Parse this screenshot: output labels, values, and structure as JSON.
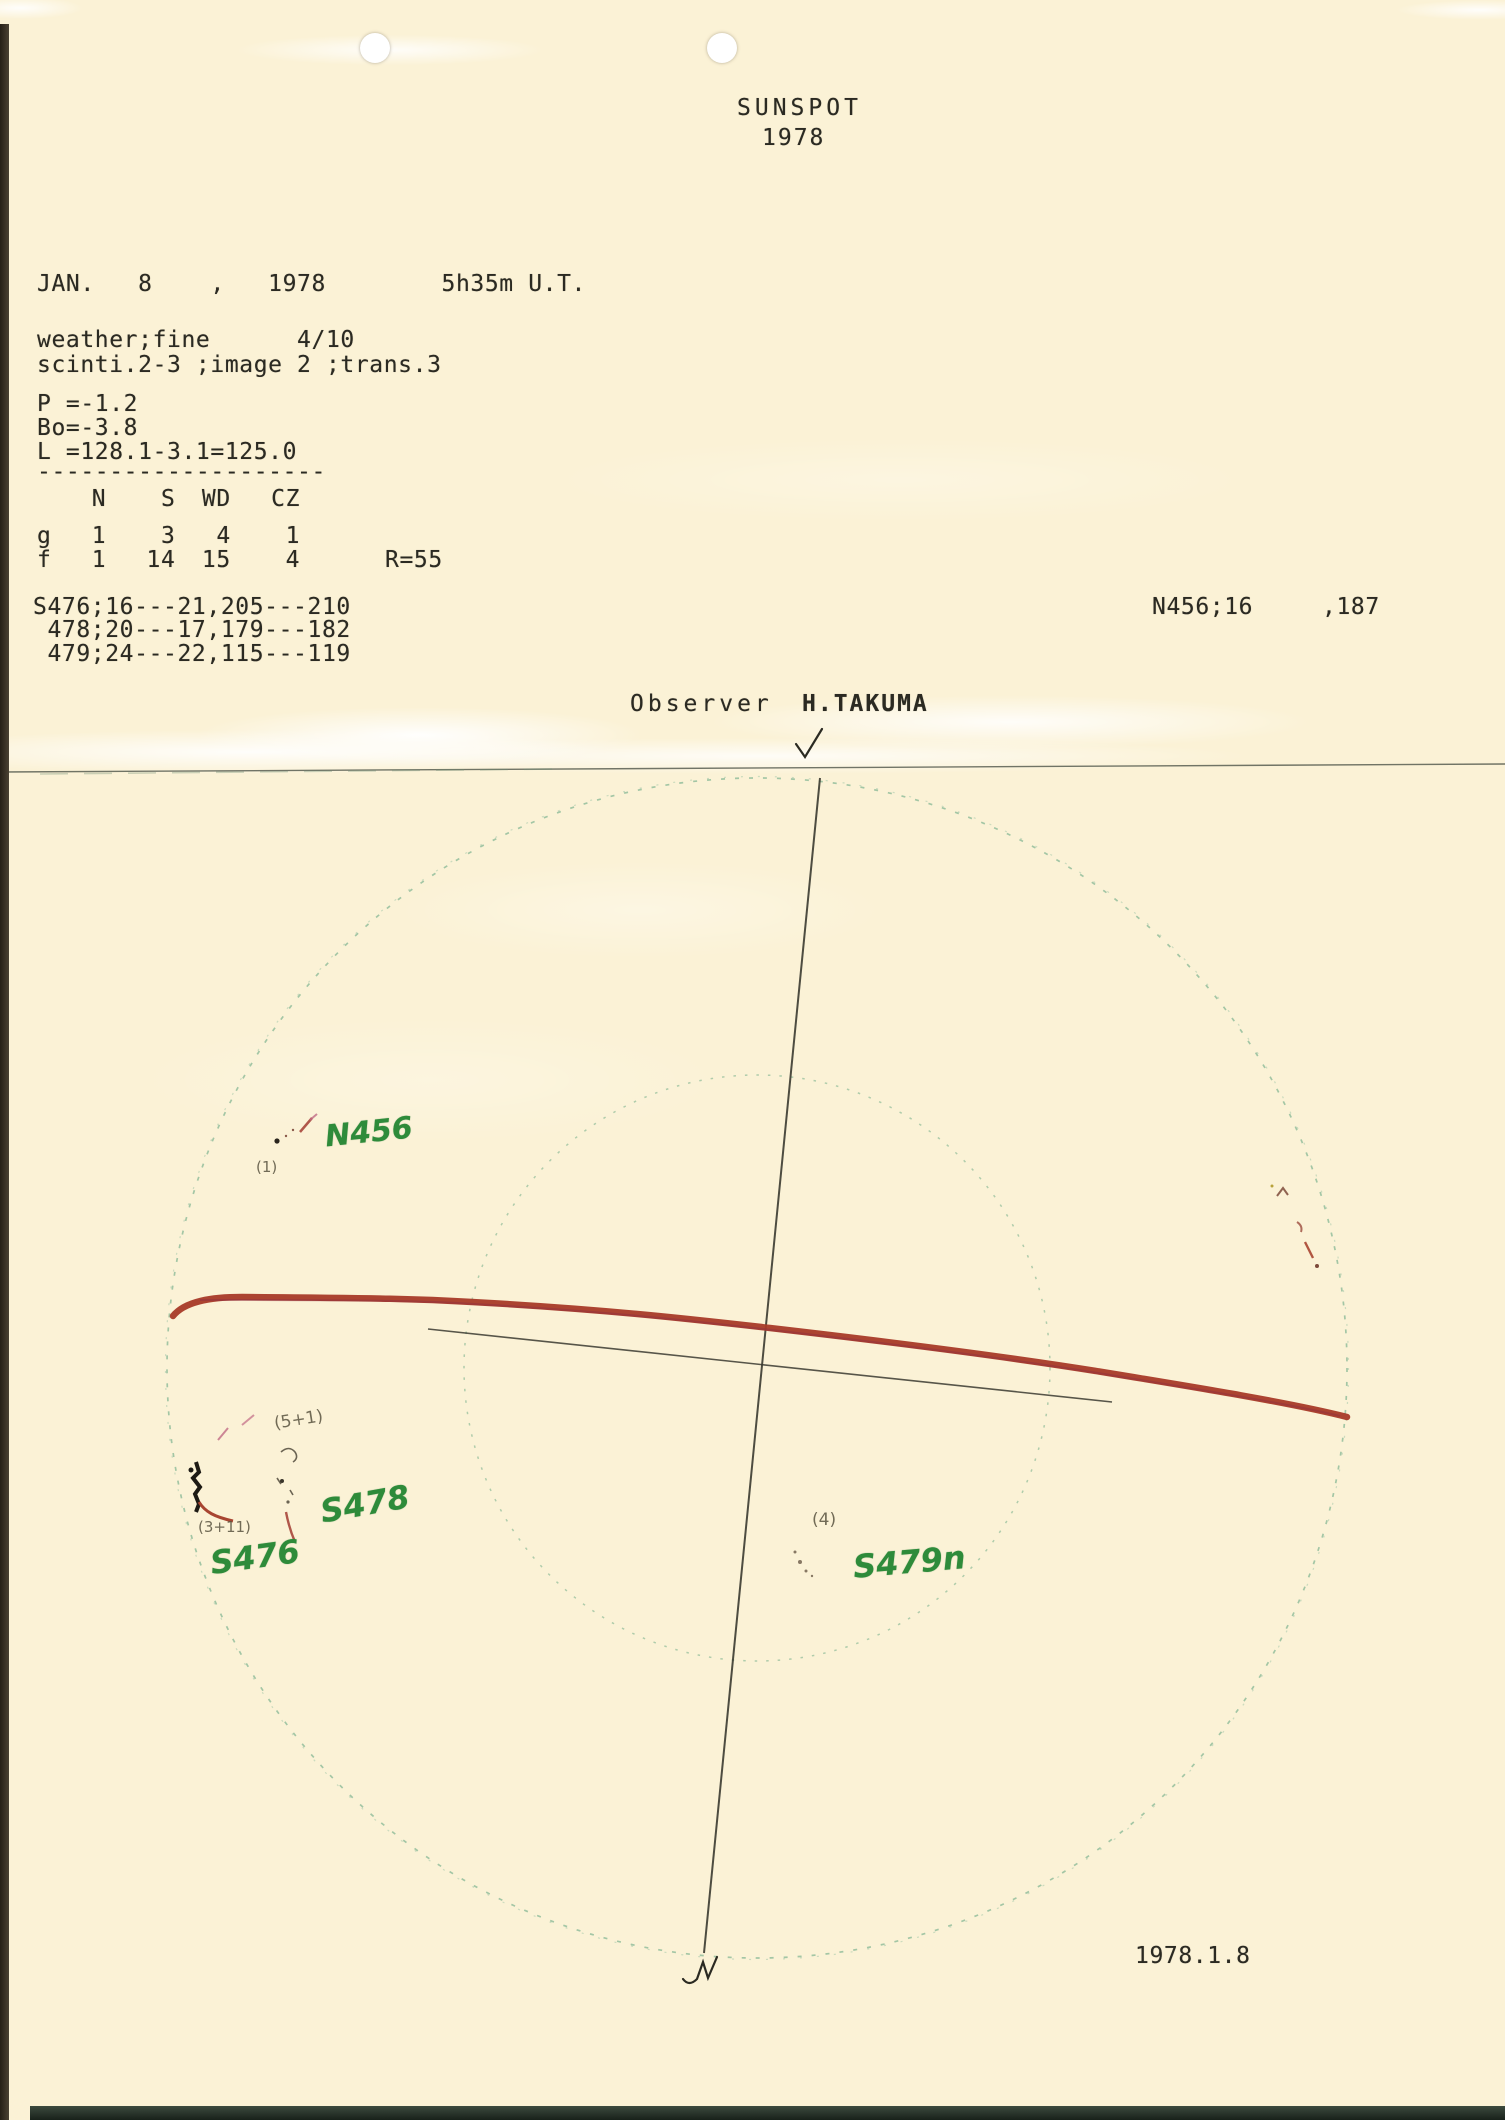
{
  "header": {
    "title": "SUNSPOT",
    "year": "1978"
  },
  "observation": {
    "date_line": "JAN.   8    ,   1978        5h35m U.T.",
    "weather_line": "weather;fine      4/10",
    "seeing_line": "scinti.2-3 ;image 2 ;trans.3",
    "p_value": "P =-1.2",
    "bo_value": "Bo=-3.8",
    "l_value": "L =128.1-3.1=125.0",
    "divider": "--------------------",
    "counts_table": {
      "col_headers": [
        "N",
        "S",
        "WD",
        "CZ"
      ],
      "rows": [
        {
          "label": "g",
          "n": "1",
          "s": "3",
          "wd": "4",
          "cz": "1"
        },
        {
          "label": "f",
          "n": "1",
          "s": "14",
          "wd": "15",
          "cz": "4"
        }
      ],
      "relative_number": "R=55"
    },
    "south_groups": [
      "S476;16---21,205---210",
      " 478;20---17,179---182",
      " 479;24---22,115---119"
    ],
    "north_group": "N456;16",
    "north_group_cmp": ",187",
    "observer_label": "Observer",
    "observer_name": "H.TAKUMA"
  },
  "diagram": {
    "label_n456": "N456",
    "count_n456": "(1)",
    "label_s478": "S478",
    "count_s478": "(5+1)",
    "label_s476": "S476",
    "count_s476": "(3+11)",
    "label_s479": "S479n",
    "count_s479": "(4)",
    "date_stamp": "1978.1.8",
    "colors": {
      "disk_outline_green": "#86b794",
      "equator_red": "#a83a28",
      "handwriting_green": "#2e8b3a",
      "pencil_gray": "#5a5440",
      "typewriter_ink": "#2b2a22"
    }
  }
}
